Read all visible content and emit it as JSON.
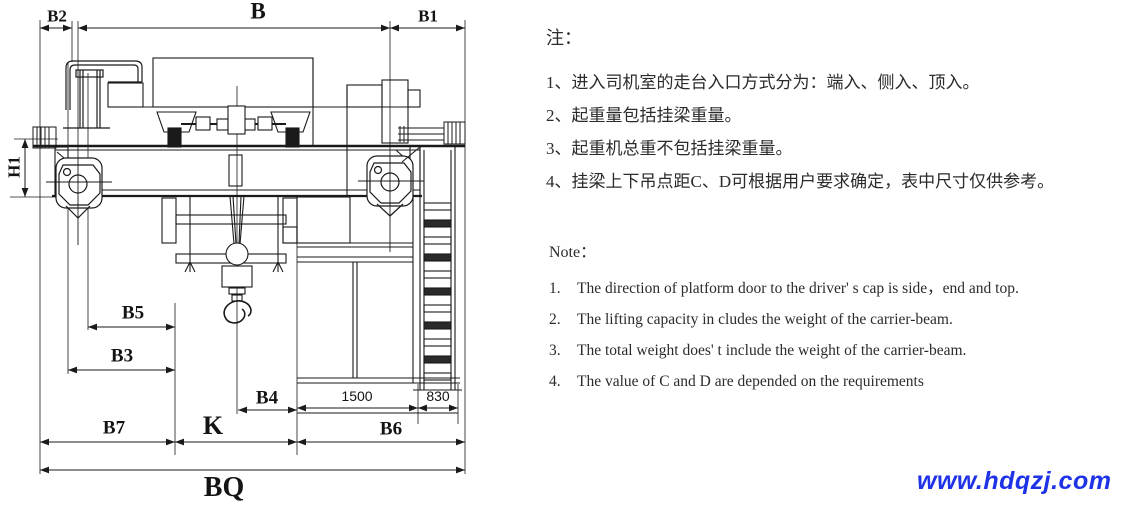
{
  "drawing": {
    "labels": {
      "b2": "B2",
      "b": "B",
      "b1": "B1",
      "h1": "H1",
      "b5": "B5",
      "b3": "B3",
      "b4": "B4",
      "b7": "B7",
      "k": "K",
      "b6": "B6",
      "bq": "BQ",
      "dim_1500": "1500",
      "dim_830": "830"
    }
  },
  "notes_cn": {
    "title": "注：",
    "items": [
      "1、进入司机室的走台入口方式分为：端入、侧入、顶入。",
      "2、起重量包括挂梁重量。",
      "3、起重机总重不包括挂梁重量。",
      "4、挂梁上下吊点距C、D可根据用户要求确定，表中尺寸仅供参考。"
    ]
  },
  "notes_en": {
    "title": "Note：",
    "items": [
      {
        "num": "1.",
        "text": "The direction of platform door to the driver' s cap is side，end and top."
      },
      {
        "num": "2.",
        "text": "The lifting capacity in cludes the weight of the carrier-beam."
      },
      {
        "num": "3.",
        "text": "The total weight does' t include the weight of the carrier-beam."
      },
      {
        "num": "4.",
        "text": "The value of C and D are depended on the requirements"
      }
    ]
  },
  "watermark": {
    "text": "www.hdqzj.com",
    "color": "#1E32E6"
  }
}
